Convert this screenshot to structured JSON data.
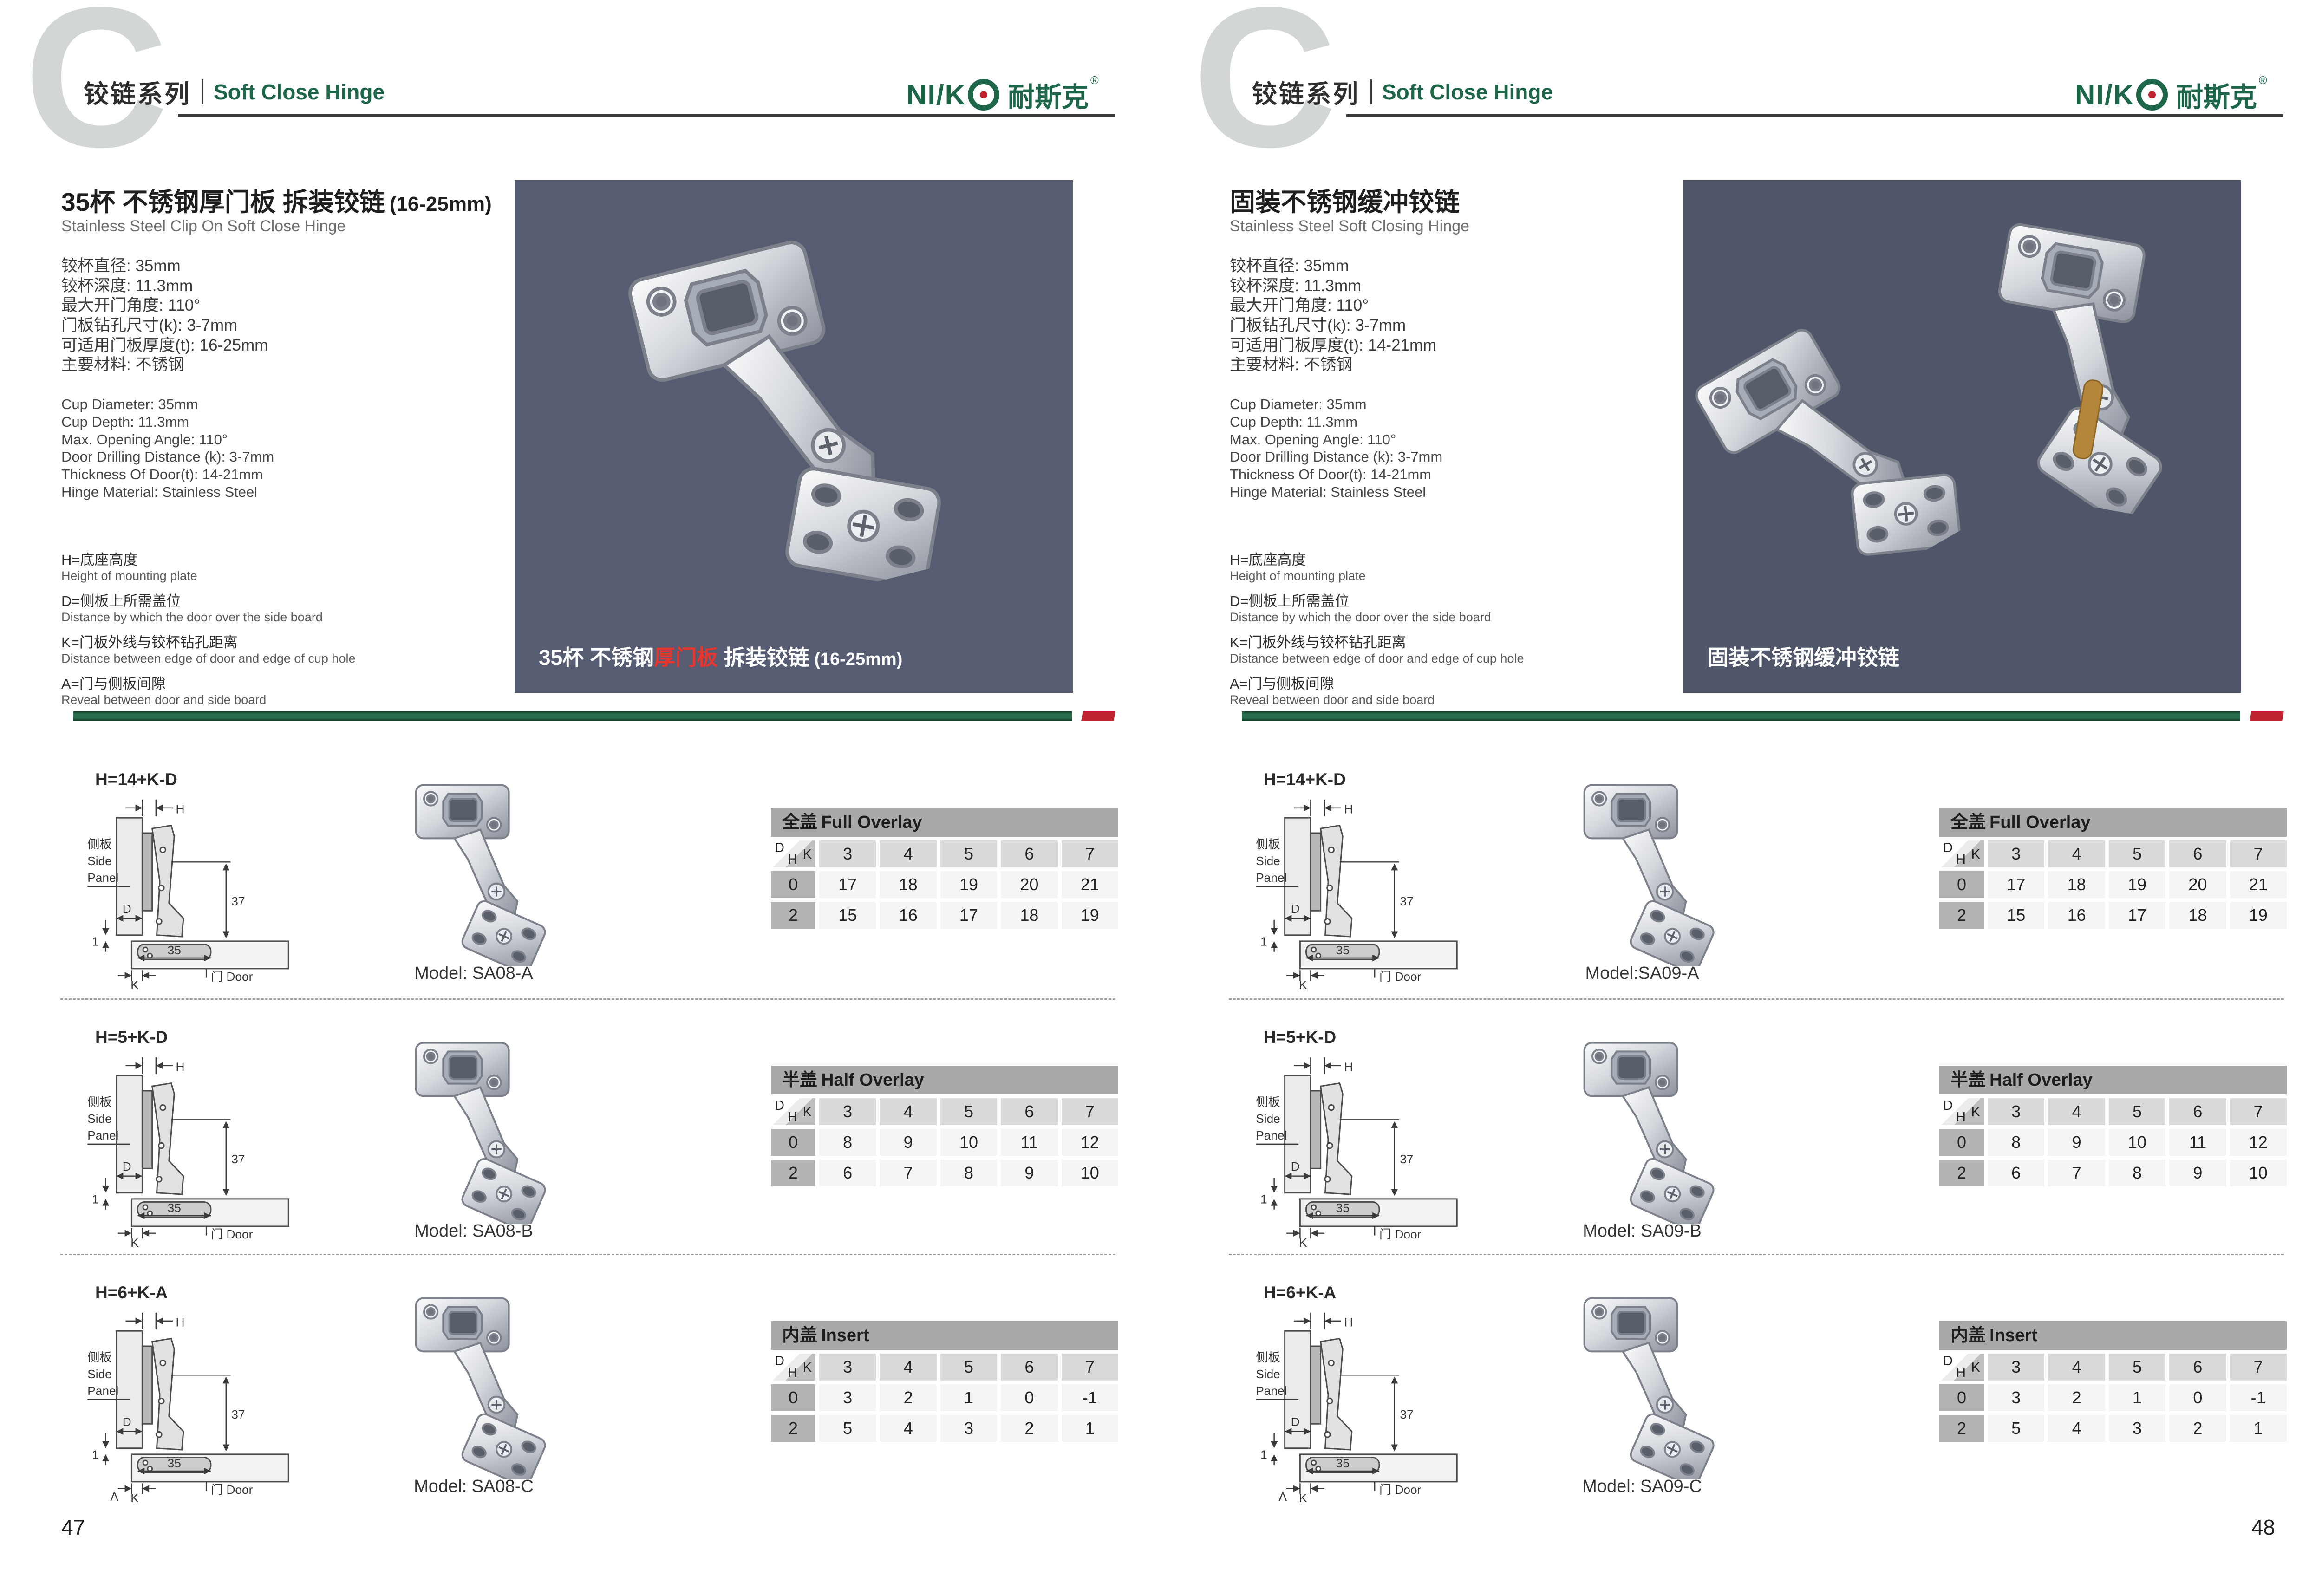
{
  "colors": {
    "green": "#1d6647",
    "red": "#bf2430",
    "hline": "#3d3d3d",
    "photo1": "#565c72",
    "photo2": "#505669",
    "tbar": "#a9a9a9"
  },
  "header": {
    "chapter_letter": "C",
    "series_cn": "铰链系列",
    "series_en": "Soft Close Hinge",
    "logo": {
      "prefix": "NI/K",
      "cn": "耐斯克",
      "reg": "®"
    }
  },
  "legend": {
    "items": [
      {
        "cn": "H=底座高度",
        "en": "Height of mounting plate"
      },
      {
        "cn": "D=侧板上所需盖位",
        "en": "Distance by which the door over the side board"
      },
      {
        "cn": "K=门板外线与铰杯钻孔距离",
        "en": "Distance between edge of door and edge of cup hole"
      },
      {
        "cn": "A=门与侧板间隙",
        "en": "Reveal between door and side board"
      }
    ]
  },
  "diagram": {
    "h": "H",
    "d": "D",
    "k": "K",
    "one": "1",
    "dim37": "37",
    "dim35": "35",
    "side_panel_cn": "侧板",
    "side_en_1": "Side",
    "side_en_2": "Panel",
    "door": "门 Door"
  },
  "tables": [
    {
      "cn": "全盖",
      "en": "Full Overlay",
      "corner": {
        "d": "D",
        "k": "K",
        "h": "H"
      },
      "cols": [
        "3",
        "4",
        "5",
        "6",
        "7"
      ],
      "rows": [
        {
          "h": "0",
          "v": [
            "17",
            "18",
            "19",
            "20",
            "21"
          ]
        },
        {
          "h": "2",
          "v": [
            "15",
            "16",
            "17",
            "18",
            "19"
          ]
        }
      ]
    },
    {
      "cn": "半盖",
      "en": "Half Overlay",
      "corner": {
        "d": "D",
        "k": "K",
        "h": "H"
      },
      "cols": [
        "3",
        "4",
        "5",
        "6",
        "7"
      ],
      "rows": [
        {
          "h": "0",
          "v": [
            "8",
            "9",
            "10",
            "11",
            "12"
          ]
        },
        {
          "h": "2",
          "v": [
            "6",
            "7",
            "8",
            "9",
            "10"
          ]
        }
      ]
    },
    {
      "cn": "内盖",
      "en": "Insert",
      "corner": {
        "d": "D",
        "k": "K",
        "h": "H"
      },
      "cols": [
        "3",
        "4",
        "5",
        "6",
        "7"
      ],
      "rows": [
        {
          "h": "0",
          "v": [
            "3",
            "2",
            "1",
            "0",
            "-1"
          ]
        },
        {
          "h": "2",
          "v": [
            "5",
            "4",
            "3",
            "2",
            "1"
          ]
        }
      ]
    }
  ],
  "pages": [
    {
      "number": "47",
      "title_cn": "35杯 不锈钢厚门板 拆装铰链",
      "title_paren": "(16-25mm)",
      "title_en": "Stainless Steel Clip On Soft Close Hinge",
      "specs_cn": [
        "铰杯直径: 35mm",
        "铰杯深度: 11.3mm",
        "最大开门角度: 110°",
        "门板钻孔尺寸(k): 3-7mm",
        "可适用门板厚度(t): 16-25mm",
        "主要材料: 不锈钢"
      ],
      "specs_en": [
        "Cup Diameter: 35mm",
        "Cup Depth: 11.3mm",
        "Max. Opening Angle: 110°",
        "Door Drilling Distance (k): 3-7mm",
        "Thickness Of Door(t): 14-21mm",
        "Hinge Material: Stainless Steel"
      ],
      "photo": {
        "cap_pre": "35杯 不锈钢",
        "cap_red": "厚门板",
        "cap_post": " 拆装铰链",
        "cap_paren": " (16-25mm)"
      },
      "rows": [
        {
          "formula": "H=14+K-D",
          "model": "Model: SA08-A"
        },
        {
          "formula": "H=5+K-D",
          "model": "Model: SA08-B"
        },
        {
          "formula": "H=6+K-A",
          "model": "Model: SA08-C",
          "a": "A"
        }
      ]
    },
    {
      "number": "48",
      "title_cn": "固装不锈钢缓冲铰链",
      "title_paren": "",
      "title_en": "Stainless Steel Soft Closing Hinge",
      "specs_cn": [
        "铰杯直径: 35mm",
        "铰杯深度: 11.3mm",
        "最大开门角度: 110°",
        "门板钻孔尺寸(k): 3-7mm",
        "可适用门板厚度(t): 14-21mm",
        "主要材料: 不锈钢"
      ],
      "specs_en": [
        "Cup Diameter: 35mm",
        "Cup Depth: 11.3mm",
        "Max. Opening Angle: 110°",
        "Door Drilling Distance (k): 3-7mm",
        "Thickness Of Door(t): 14-21mm",
        "Hinge Material: Stainless Steel"
      ],
      "photo": {
        "cap_pre": "固装不锈钢缓冲铰链",
        "cap_red": "",
        "cap_post": "",
        "cap_paren": ""
      },
      "rows": [
        {
          "formula": "H=14+K-D",
          "model": "Model:SA09-A"
        },
        {
          "formula": "H=5+K-D",
          "model": "Model: SA09-B"
        },
        {
          "formula": "H=6+K-A",
          "model": "Model: SA09-C",
          "a": "A"
        }
      ]
    }
  ]
}
